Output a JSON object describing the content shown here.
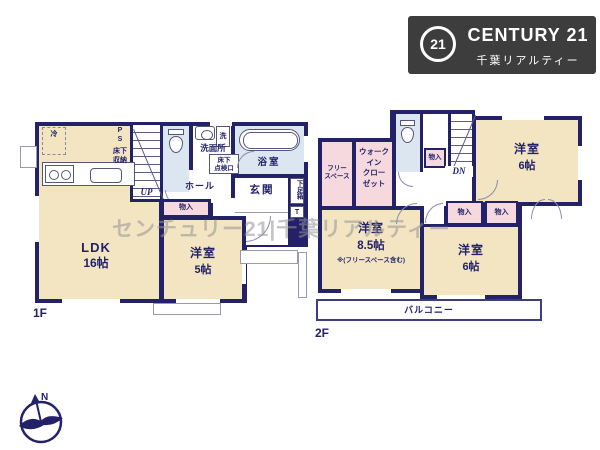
{
  "logo": {
    "circle_number": "21",
    "brand": "CENTURY 21",
    "subtitle": "千葉リアルティー"
  },
  "watermark": "センチュリー21|千葉リアルティー",
  "compass": {
    "north": "N"
  },
  "floor1": {
    "label": "1F",
    "ldk": {
      "name": "LDK",
      "size": "16帖"
    },
    "bedroom5": {
      "name": "洋室",
      "size": "5帖"
    },
    "fridge": "冷",
    "pipe_space": "P\nS",
    "underfloor_storage": "床下\n収納",
    "stairs_up": "UP",
    "washroom": "洗面所",
    "washer": "洗",
    "inspection_hatch": "床下\n点検口",
    "bathroom": "浴室",
    "hall": "ホール",
    "entrance": "玄関",
    "shoe_box": "下足箱",
    "shoe_box_t": "T",
    "closet": "物入"
  },
  "floor2": {
    "label": "2F",
    "free_space": "フリー\nスペース",
    "walk_in_closet": "ウォーク\nイン\nクロー\nゼット",
    "closet": "物入",
    "stairs_down": "DN",
    "bedroom6a": {
      "name": "洋室",
      "size": "6帖"
    },
    "bedroom85": {
      "name": "洋室",
      "size": "8.5帖",
      "note": "※(フリースペース含む)"
    },
    "bedroom6b": {
      "name": "洋室",
      "size": "6帖"
    },
    "balcony": "バルコニー"
  },
  "colors": {
    "wall": "#232269",
    "room": "#f3e5c2",
    "closet": "#f6d9de",
    "wet_area": "#dce6f1",
    "logo_bg": "#3d3d3d"
  }
}
